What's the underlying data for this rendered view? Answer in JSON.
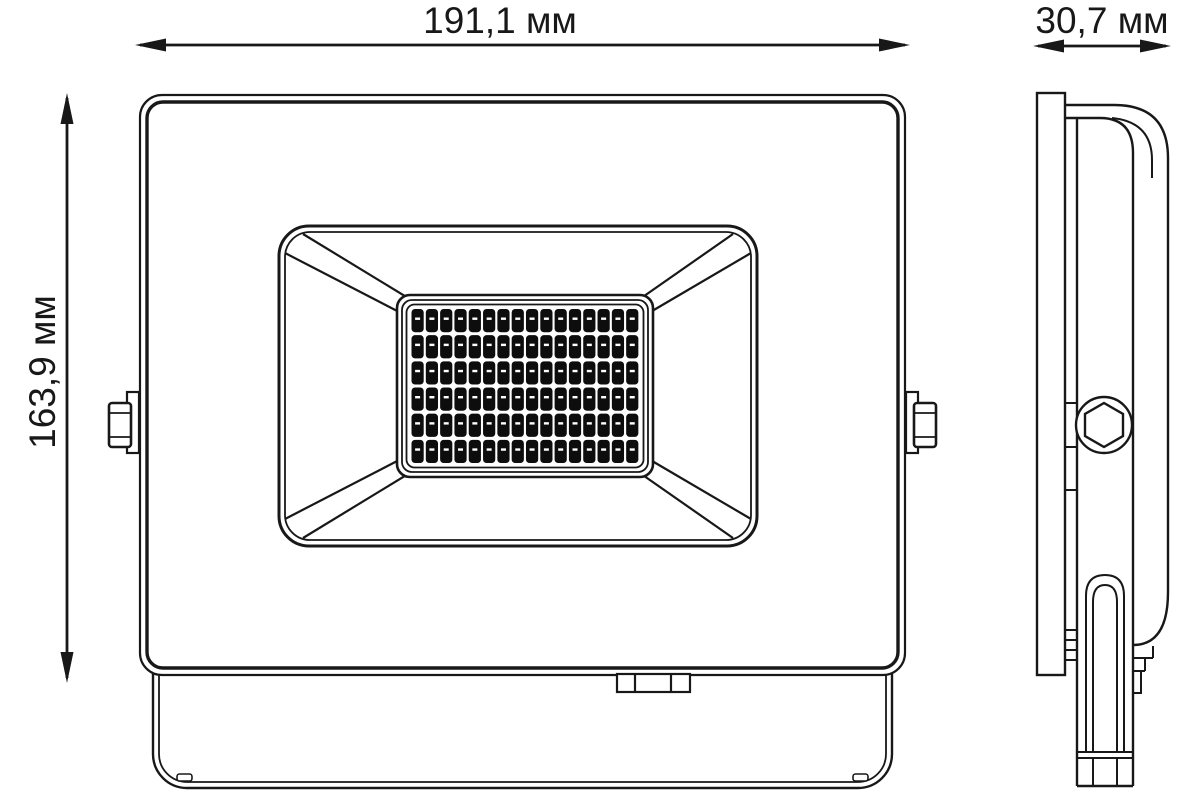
{
  "title": "LED floodlight dimensional drawing",
  "colors": {
    "background": "#ffffff",
    "line": "#181818",
    "led_chip": "#0d0d0d",
    "led_dash": "#ffffff"
  },
  "dimensions": {
    "width": {
      "label": "191,1 мм"
    },
    "height": {
      "label": "163,9 мм"
    },
    "depth": {
      "label": "30,7 мм"
    }
  },
  "front_view": {
    "led_grid": {
      "rows": 6,
      "cols": 16
    }
  }
}
